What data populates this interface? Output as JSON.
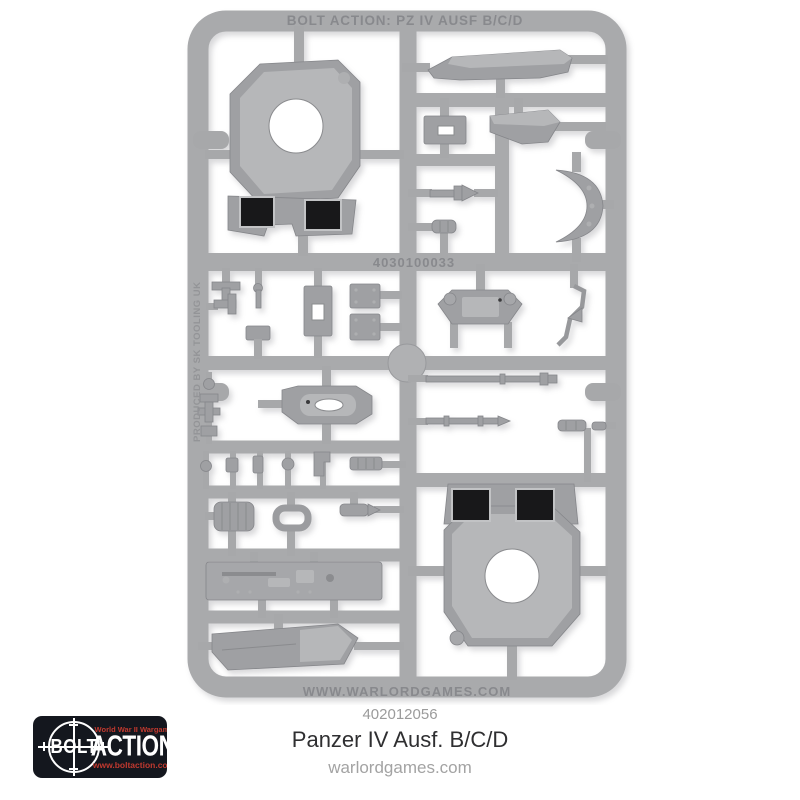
{
  "photo": {
    "background_color": "#ffffff",
    "sprue": {
      "plastic_color": "#a9aaac",
      "embossed_top_text": "BOLT ACTION: PZ IV AUSF B/C/D",
      "embossed_mould_code": "4030100033",
      "embossed_bottom_text": "WWW.WARLORDGAMES.COM",
      "embossed_side_text": "PRODUCED BY SK TOOLING UK",
      "parts": [
        "turret-roof-with-ring-opening-and-hatch-holes",
        "angled-hull-plate",
        "slotted-small-plate",
        "stepped-front-plate",
        "gun-mantlet-crescent",
        "tapered-barrel-fitting",
        "small-cylinder-fitting",
        "t-bracket",
        "pin-fitting",
        "side-bracket",
        "small-plate",
        "slotted-vertical-plate",
        "square-plate",
        "square-plate-2",
        "hinged-hatch-plate",
        "bent-rod-fitting",
        "small-fittings-column",
        "oval-hatch-plate",
        "long-gun-barrel",
        "short-gun-barrel",
        "cylinder-fittings",
        "small-fittings-row",
        "ribbed-muffler",
        "link-ring",
        "bullet-cylinder",
        "tool-stowage-plate",
        "angled-glacis-plate",
        "turret-base-with-ring-opening-and-hatch-holes"
      ]
    }
  },
  "caption": {
    "sku": "402012056",
    "title": "Panzer IV Ausf. B/C/D",
    "website": "warlordgames.com"
  },
  "logo": {
    "tagline": "World War II Wargame",
    "brand_scope_word": "BOLT",
    "brand_main_word": "ACTION",
    "registered_mark": "®",
    "website": "www.boltaction.com",
    "background_color": "#14171e",
    "red_color": "#c1392f"
  }
}
